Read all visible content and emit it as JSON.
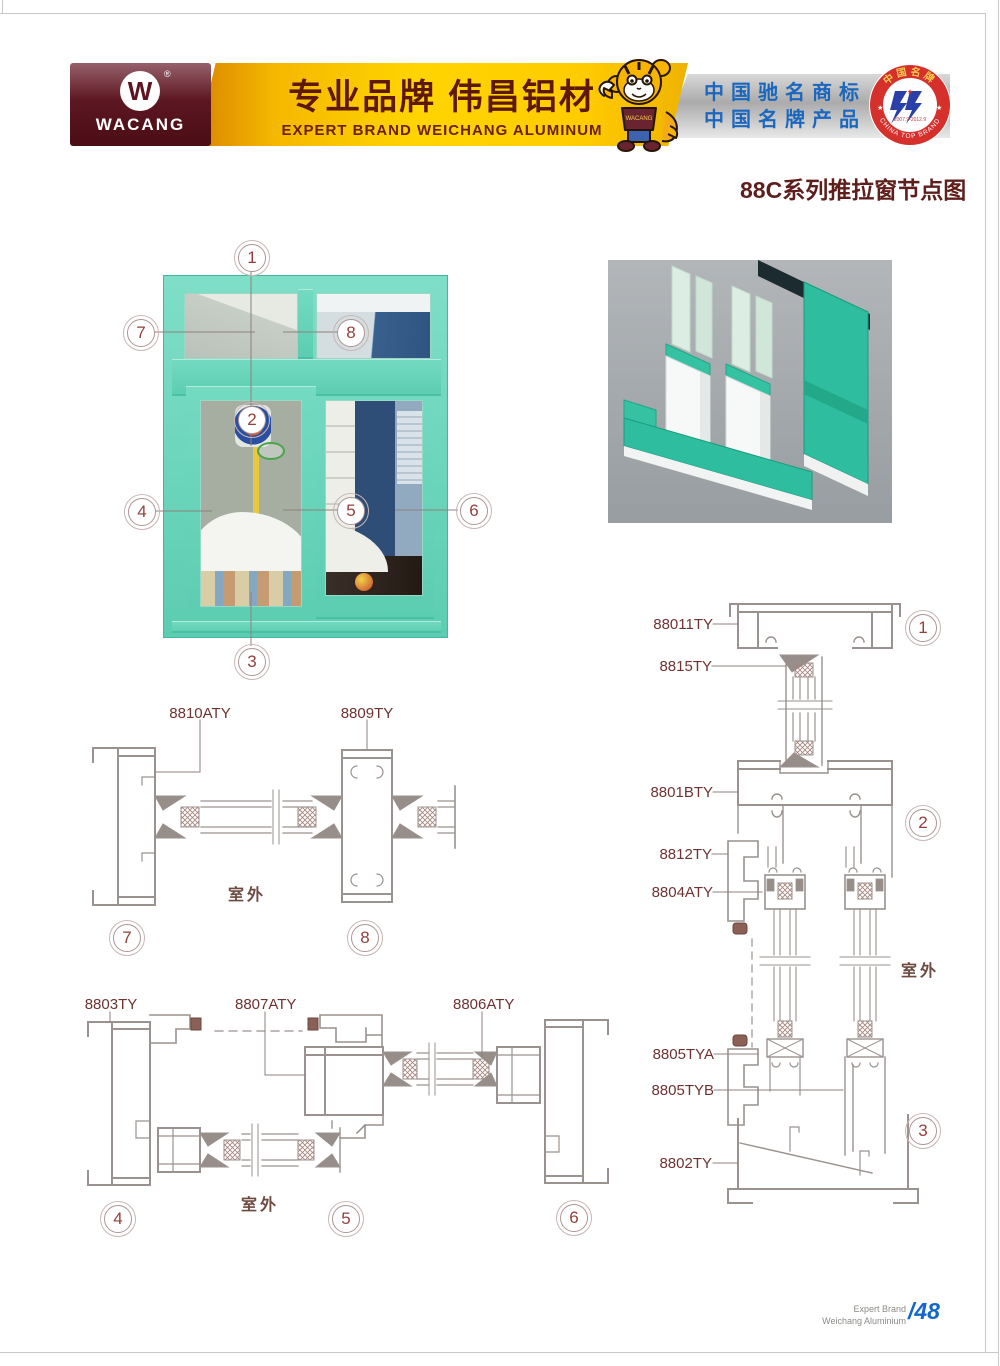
{
  "header": {
    "logo": {
      "brand": "WACANG",
      "mark": "W",
      "registered": "®"
    },
    "slogan_cn": "专业品牌  伟昌铝材",
    "slogan_en": "EXPERT BRAND WEICHANG ALUMINUM",
    "honor_line1": "中国驰名商标",
    "honor_line2": "中国名牌产品",
    "seal": {
      "arc_top": "中国名牌",
      "arc_bottom": "CHINA TOP BRAND",
      "dates": "2007.9-2012.9"
    }
  },
  "title": "88C系列推拉窗节点图",
  "window_figure": {
    "callouts": [
      "1",
      "2",
      "3",
      "4",
      "5",
      "6",
      "7",
      "8"
    ]
  },
  "details": {
    "left_mid": {
      "part_labels": [
        {
          "text": "8810ATY"
        },
        {
          "text": "8809TY"
        }
      ],
      "outdoor": "室外",
      "callouts": [
        "7",
        "8"
      ]
    },
    "left_bottom": {
      "part_labels": [
        {
          "text": "8803TY"
        },
        {
          "text": "8807ATY"
        },
        {
          "text": "8806ATY"
        }
      ],
      "outdoor": "室外",
      "callouts": [
        "4",
        "5",
        "6"
      ]
    },
    "right": {
      "part_labels": [
        {
          "text": "88011TY"
        },
        {
          "text": "8815TY"
        },
        {
          "text": "8801BTY"
        },
        {
          "text": "8812TY"
        },
        {
          "text": "8804ATY"
        },
        {
          "text": "8805TYA"
        },
        {
          "text": "8805TYB"
        },
        {
          "text": "8802TY"
        }
      ],
      "outdoor": "室外",
      "callouts": [
        "1",
        "2",
        "3"
      ]
    }
  },
  "footer": {
    "brand_line1": "Expert Brand",
    "brand_line2": "Weichang Aluminium",
    "page_number": "/48"
  },
  "colors": {
    "teal": "#5ECDB2",
    "maroon": "#5E1E1C",
    "gold": "#FFCC00",
    "silver": "#C9C9C9",
    "badge_red": "#D5302B",
    "brand_blue": "#1C67BE",
    "page_blue": "#1467C8",
    "drawing_gray": "#9A928E",
    "label_maroon": "#6E3230"
  }
}
